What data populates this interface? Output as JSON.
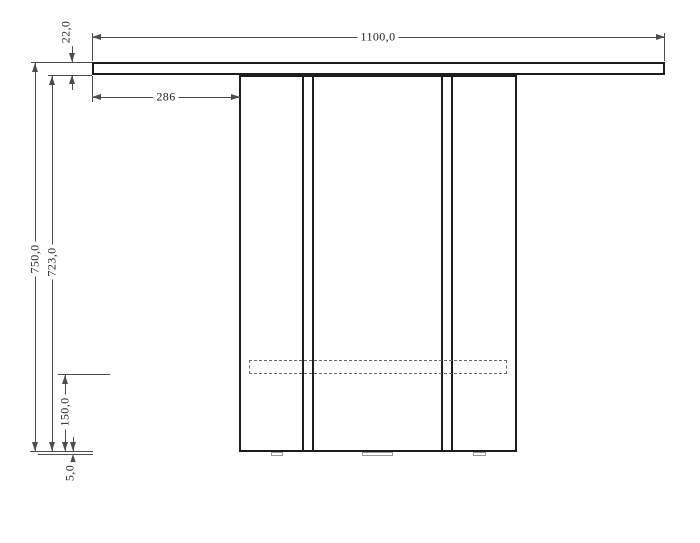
{
  "drawing": {
    "kind": "technical dimension drawing, front elevation of a table/console",
    "dims": {
      "top_width": "1100,0",
      "top_thickness": "22,0",
      "left_offset": "286",
      "overall_height": "750,0",
      "body_height": "723,0",
      "stretcher_bottom_offset": "150,0",
      "glide_height": "5,0"
    }
  },
  "colors": {
    "object_line": "#1d1d1d",
    "dim_line": "#4d4d4d",
    "hidden_line": "#6e6e6e",
    "glide_line": "#9a9a9a",
    "text_color": "#222222",
    "bg": "#ffffff"
  }
}
